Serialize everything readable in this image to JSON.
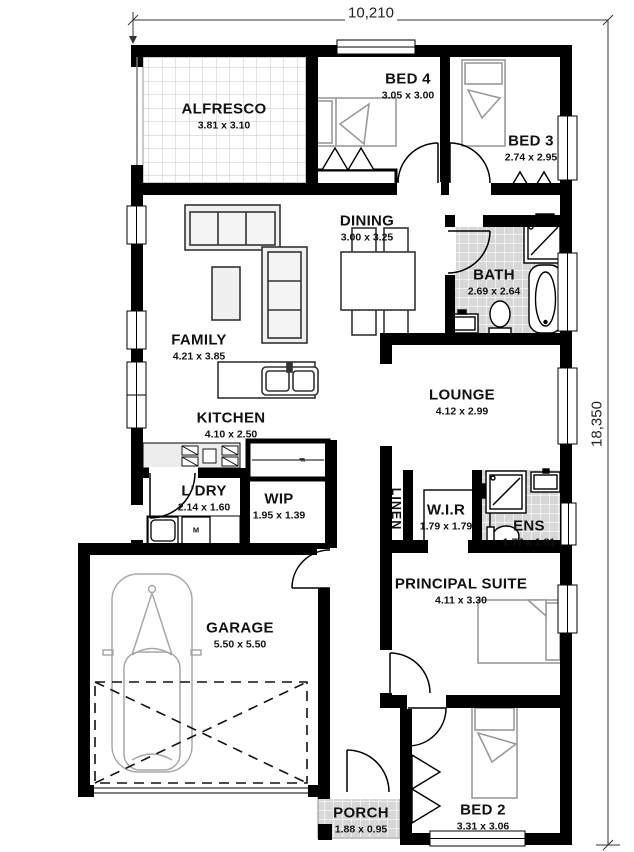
{
  "plan": {
    "type": "residential floor plan",
    "overall_width": "10,210",
    "overall_depth": "18,350"
  },
  "rooms": {
    "alfresco": {
      "name": "ALFRESCO",
      "size": "3.81 x 3.10"
    },
    "bed4": {
      "name": "BED 4",
      "size": "3.05 x 3.00"
    },
    "bed3": {
      "name": "BED 3",
      "size": "2.74 x 2.95"
    },
    "dining": {
      "name": "DINING",
      "size": "3.00 x 3.25"
    },
    "bath": {
      "name": "BATH",
      "size": "2.69 x 2.64"
    },
    "family": {
      "name": "FAMILY",
      "size": "4.21 x 3.85"
    },
    "kitchen": {
      "name": "KITCHEN",
      "size": "4.10 x 2.50"
    },
    "lounge": {
      "name": "LOUNGE",
      "size": "4.12 x 2.99"
    },
    "ldry": {
      "name": "L'DRY",
      "size": "2.14 x 1.60"
    },
    "wip": {
      "name": "WIP",
      "size": "1.95 x 1.39"
    },
    "linen": {
      "name": "LINEN"
    },
    "wir": {
      "name": "W.I.R",
      "size": "1.79 x 1.79"
    },
    "ens": {
      "name": "ENS",
      "size": "1.77 x 1.81"
    },
    "principal": {
      "name": "PRINCIPAL SUITE",
      "size": "4.11 x 3.30"
    },
    "garage": {
      "name": "GARAGE",
      "size": "5.50 x 5.50"
    },
    "porch": {
      "name": "PORCH",
      "size": "1.88 x 0.95"
    },
    "bed2": {
      "name": "BED 2",
      "size": "3.31 x 3.06"
    }
  },
  "appliance_markers": {
    "washing_machine": "M",
    "fridge": "F"
  },
  "colors": {
    "wall": "#000000",
    "tile_gray": "#d7d7d7",
    "furniture_outline": "#9a9a9a"
  }
}
